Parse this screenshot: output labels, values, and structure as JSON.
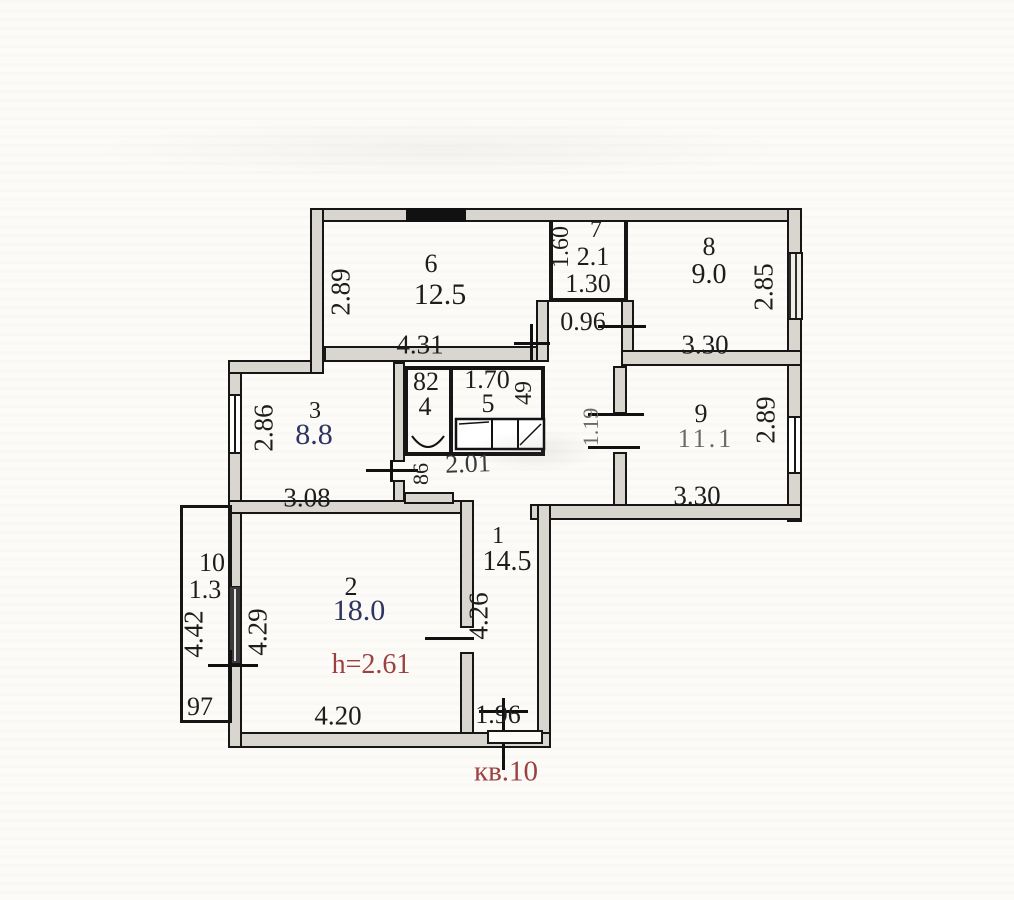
{
  "plan": {
    "apartment_label": "кв.10",
    "rooms": {
      "r1": {
        "number": "1",
        "area": "14.5",
        "dim_length": "4.26",
        "dim_entry": "1.96"
      },
      "r2": {
        "number": "2",
        "area": "18.0",
        "dim_left": "4.29",
        "dim_bottom": "4.20",
        "ceiling_height": "h=2.61"
      },
      "r3": {
        "number": "3",
        "area": "8.8",
        "dim_left": "2.86",
        "dim_bottom": "3.08"
      },
      "r4": {
        "number": "4",
        "dim_top": "82"
      },
      "r5": {
        "number": "5",
        "dim_top": "1.70",
        "dim_right": "49"
      },
      "r6": {
        "number": "6",
        "area": "12.5",
        "dim_left": "2.89",
        "dim_bottom": "4.31"
      },
      "r7": {
        "number": "7",
        "area": "2.1",
        "dim_left": "1.60",
        "dim_bottom": "1.30"
      },
      "r8": {
        "number": "8",
        "area": "9.0",
        "dim_right": "2.85",
        "dim_bottom": "3.30"
      },
      "r9": {
        "number": "9",
        "area": "11.1",
        "dim_right": "2.89",
        "dim_bottom": "3.30",
        "dim_door": "1.19"
      },
      "r10": {
        "number": "10",
        "area": "1.3",
        "dim_left": "4.42",
        "dim_bottom": "97"
      }
    },
    "hall": {
      "dim_width": "0.96",
      "dim_corridor": "2.01",
      "dim_door": "86"
    },
    "colors": {
      "ink": "#1d1d1d",
      "accent_red": "#9c4040",
      "area_navy": "#2e3560",
      "wall_fill": "#d9d6d0",
      "paper": "#fcfbf7"
    }
  }
}
